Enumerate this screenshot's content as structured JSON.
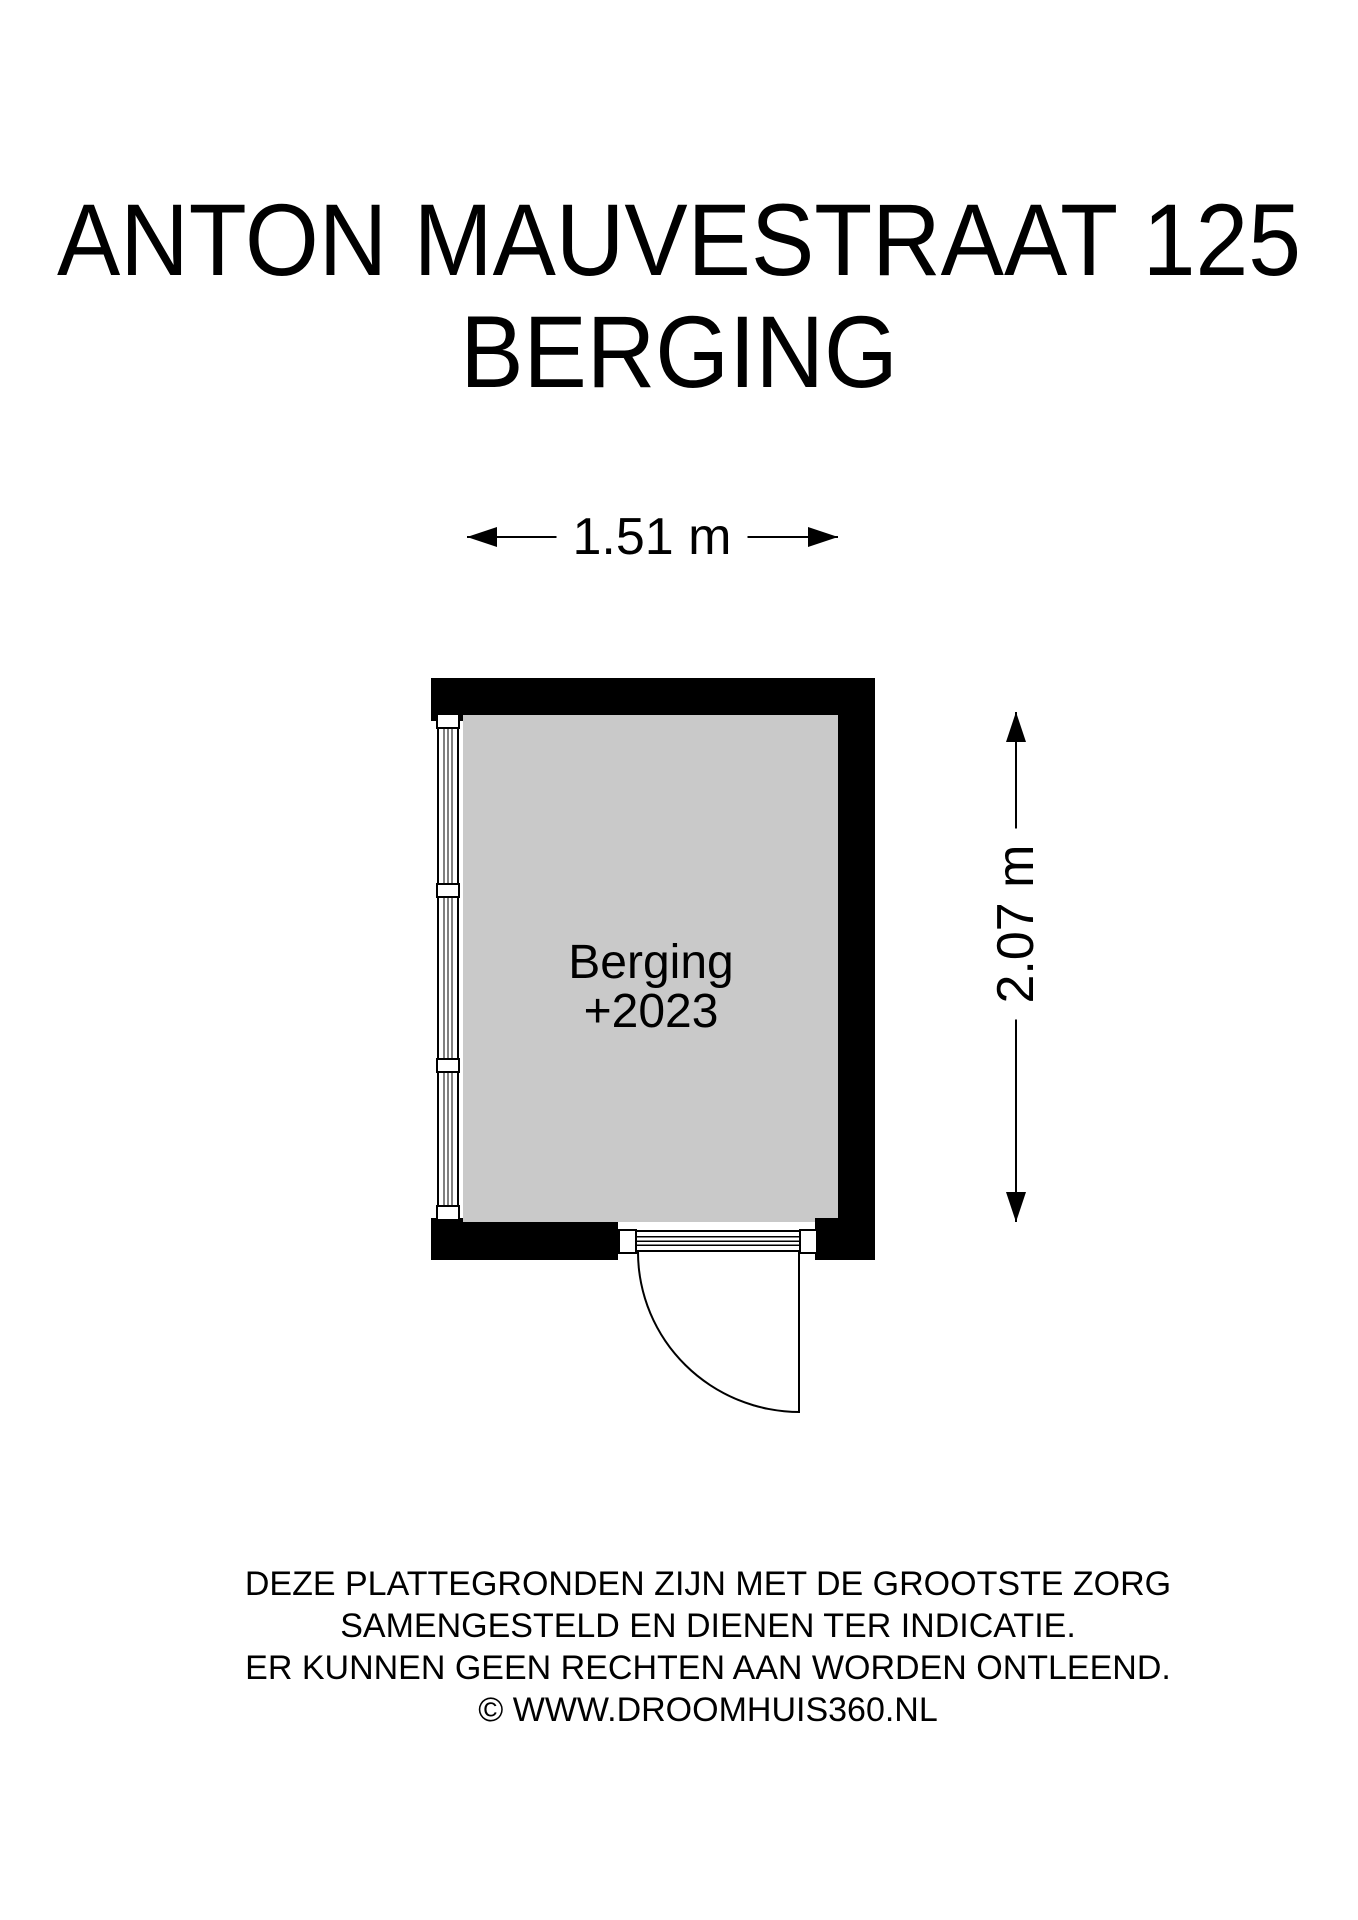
{
  "page": {
    "title_line1": "ANTON MAUVESTRAAT 125",
    "title_line2": "BERGING"
  },
  "floorplan": {
    "room": {
      "name": "Berging",
      "level": "+2023"
    },
    "dim_width": {
      "label": "1.51 m"
    },
    "dim_height": {
      "label": "2.07 m"
    }
  },
  "footer": {
    "line1": "DEZE PLATTEGRONDEN ZIJN MET DE GROOTSTE ZORG",
    "line2": "SAMENGESTELD EN DIENEN TER INDICATIE.",
    "line3": "ER KUNNEN GEEN RECHTEN AAN WORDEN ONTLEEND.",
    "line4": "© WWW.DROOMHUIS360.NL"
  },
  "colors": {
    "wall": "#000000",
    "room_fill": "#c9c9c9",
    "background": "#ffffff"
  }
}
